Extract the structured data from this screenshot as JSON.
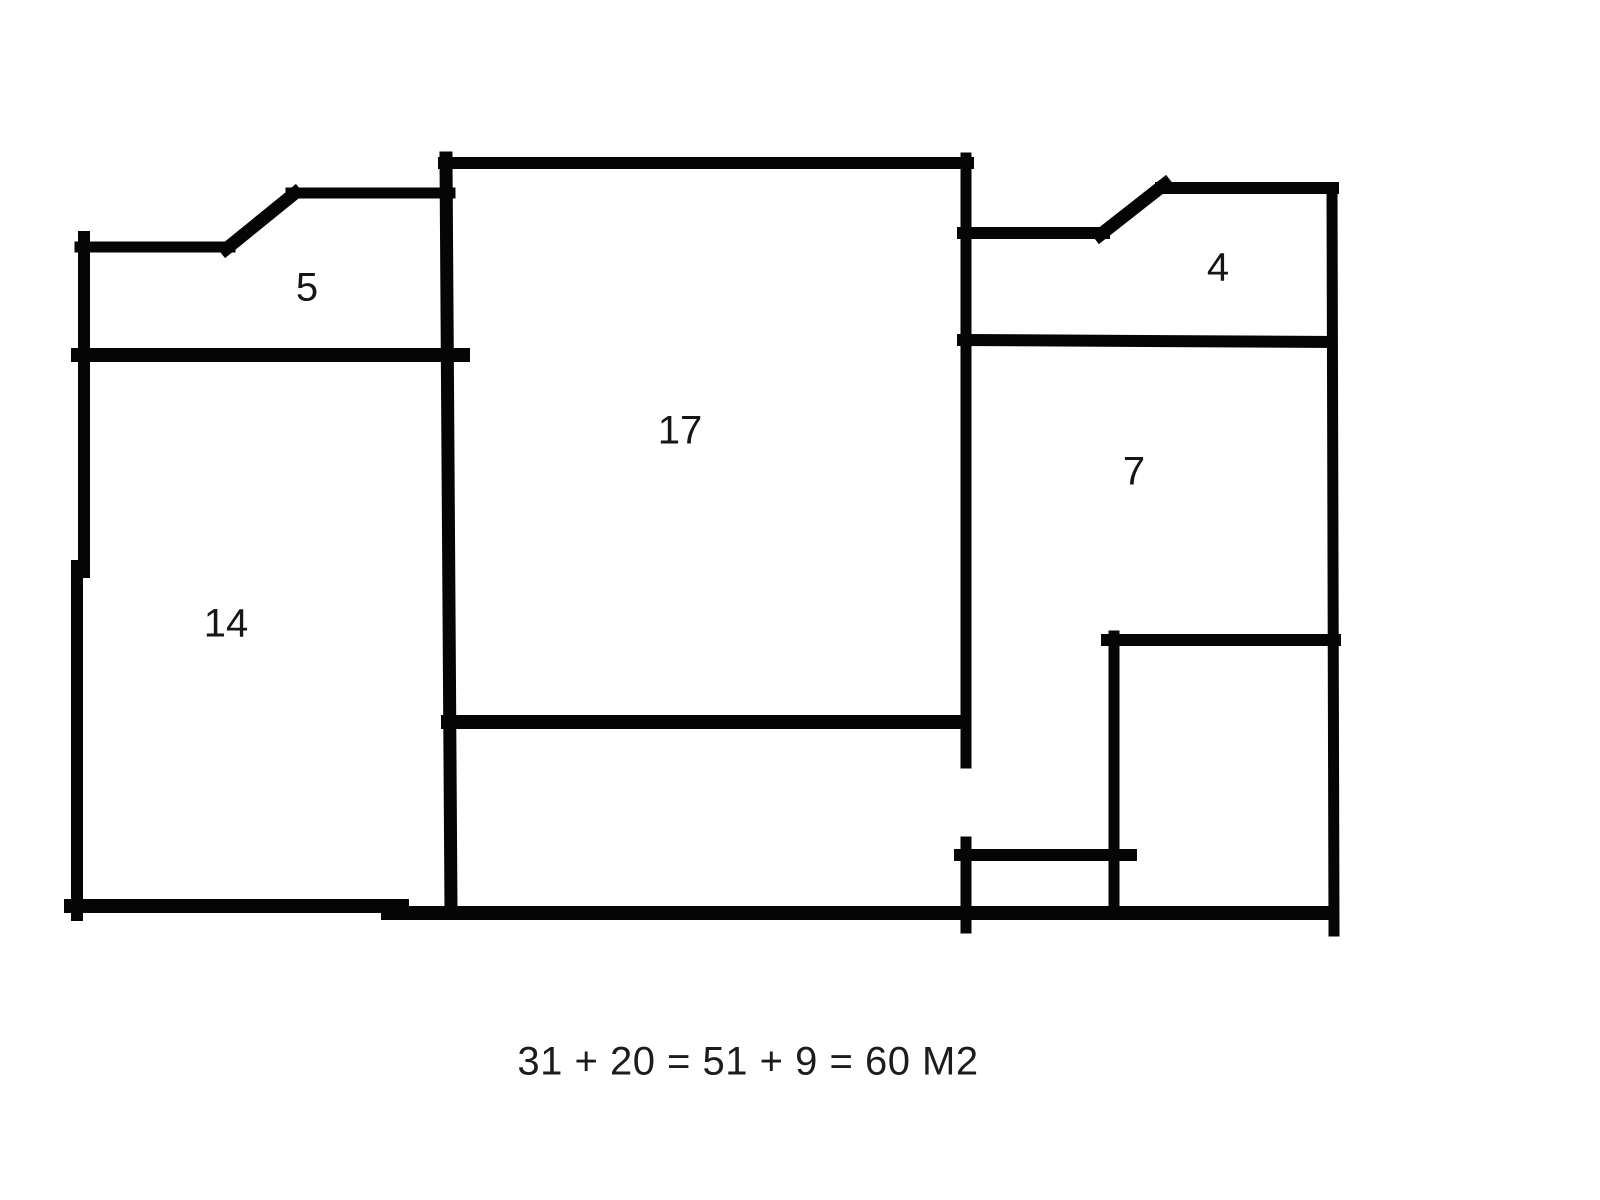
{
  "diagram": {
    "type": "hand-drawn floor plan sketch",
    "background": "#ffffff",
    "wall_color": "#050505",
    "label_color": "#161616",
    "label_font_size": 40,
    "rooms": [
      {
        "label": "5",
        "x": 307,
        "y": 288
      },
      {
        "label": "17",
        "x": 680,
        "y": 431
      },
      {
        "label": "4",
        "x": 1218,
        "y": 268
      },
      {
        "label": "14",
        "x": 226,
        "y": 624
      },
      {
        "label": "7",
        "x": 1134,
        "y": 472
      }
    ],
    "walls": [
      {
        "name": "left-wall-upper",
        "x1": 84,
        "y1": 237,
        "x2": 84,
        "y2": 572,
        "w": 12
      },
      {
        "name": "left-wall-lower",
        "x1": 77,
        "y1": 566,
        "x2": 77,
        "y2": 915,
        "w": 12
      },
      {
        "name": "room5-top-left",
        "x1": 80,
        "y1": 247,
        "x2": 230,
        "y2": 247,
        "w": 11
      },
      {
        "name": "room5-top-diagonal",
        "x1": 226,
        "y1": 249,
        "x2": 295,
        "y2": 193,
        "w": 13
      },
      {
        "name": "room5-top-right",
        "x1": 291,
        "y1": 193,
        "x2": 450,
        "y2": 193,
        "w": 11
      },
      {
        "name": "room5-bottom",
        "x1": 78,
        "y1": 355,
        "x2": 463,
        "y2": 355,
        "w": 14
      },
      {
        "name": "block17-left-wall",
        "x1": 446,
        "y1": 158,
        "x2": 451,
        "y2": 910,
        "w": 13
      },
      {
        "name": "block17-top-wall",
        "x1": 444,
        "y1": 163,
        "x2": 968,
        "y2": 163,
        "w": 12
      },
      {
        "name": "block17-right-wall",
        "x1": 966,
        "y1": 158,
        "x2": 966,
        "y2": 763,
        "w": 11
      },
      {
        "name": "block17-bottom-wall",
        "x1": 448,
        "y1": 722,
        "x2": 962,
        "y2": 722,
        "w": 14
      },
      {
        "name": "room4-top-left",
        "x1": 963,
        "y1": 233,
        "x2": 1104,
        "y2": 233,
        "w": 12
      },
      {
        "name": "room4-top-diagonal",
        "x1": 1100,
        "y1": 235,
        "x2": 1165,
        "y2": 184,
        "w": 13
      },
      {
        "name": "room4-top-right",
        "x1": 1161,
        "y1": 188,
        "x2": 1333,
        "y2": 188,
        "w": 12
      },
      {
        "name": "right-outer-wall",
        "x1": 1332,
        "y1": 188,
        "x2": 1334,
        "y2": 931,
        "w": 11
      },
      {
        "name": "room4-bottom",
        "x1": 963,
        "y1": 340,
        "x2": 1331,
        "y2": 342,
        "w": 12
      },
      {
        "name": "closet-left-wall",
        "x1": 1114,
        "y1": 636,
        "x2": 1114,
        "y2": 913,
        "w": 11
      },
      {
        "name": "closet-top-wall",
        "x1": 1107,
        "y1": 640,
        "x2": 1335,
        "y2": 640,
        "w": 12
      },
      {
        "name": "door-post-vertical",
        "x1": 966,
        "y1": 842,
        "x2": 966,
        "y2": 928,
        "w": 11
      },
      {
        "name": "inner-horizontal",
        "x1": 960,
        "y1": 855,
        "x2": 1131,
        "y2": 855,
        "w": 12
      },
      {
        "name": "bottom-wall-left",
        "x1": 71,
        "y1": 906,
        "x2": 402,
        "y2": 906,
        "w": 14
      },
      {
        "name": "bottom-wall-right",
        "x1": 388,
        "y1": 913,
        "x2": 1329,
        "y2": 913,
        "w": 14
      }
    ]
  },
  "formula": {
    "text": "31 + 20 = 51 + 9 = 60 M2",
    "x": 748,
    "y": 1062,
    "font_size": 40
  }
}
